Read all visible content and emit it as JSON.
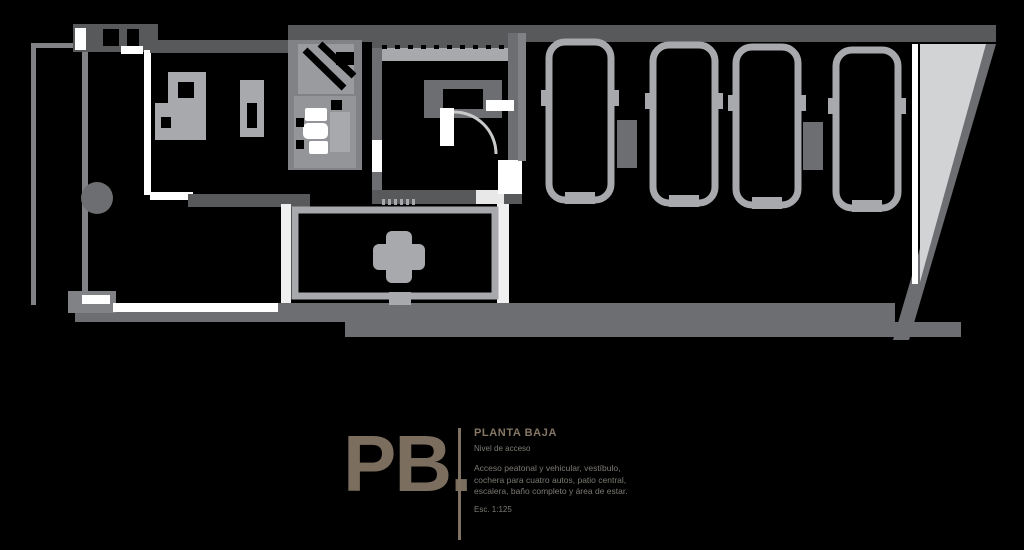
{
  "plan": {
    "name": "ground-floor-plan",
    "colors": {
      "background": "#000000",
      "wall_dark": "#58595b",
      "wall_mid": "#6d6e71",
      "wall_light": "#808285",
      "fill_gray": "#939598",
      "fill_light": "#a7a9ac",
      "ramp_fill": "#d1d3d4",
      "fixture_white": "#ffffff",
      "accent_brown": "#7b6e5f"
    }
  },
  "caption": {
    "label": "PB.",
    "title": "PLANTA BAJA",
    "subtitle": "Nivel de acceso",
    "description_lines": [
      "Acceso peatonal y vehicular, vestíbulo,",
      "cochera para cuatro autos, patio central,",
      "escalera, baño completo y área de estar."
    ],
    "footnote": "Esc. 1:125"
  }
}
